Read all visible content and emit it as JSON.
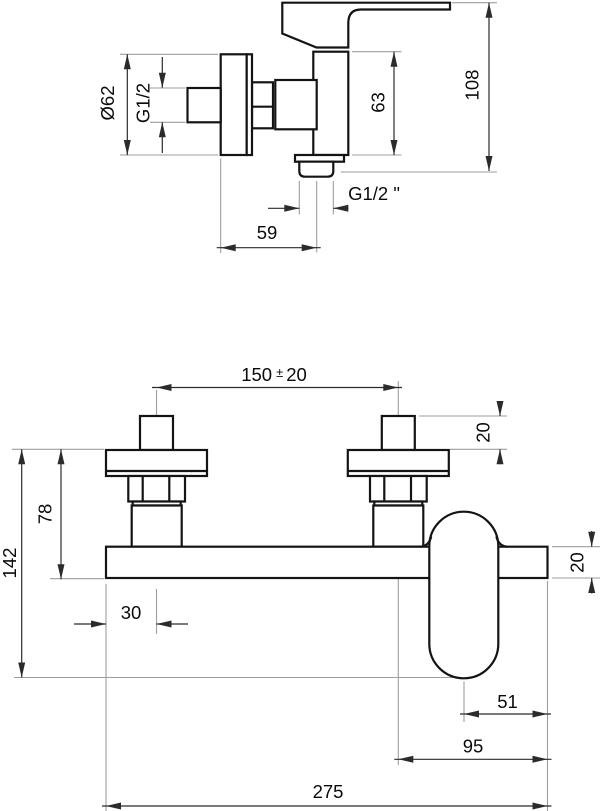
{
  "drawing": {
    "type": "technical-dimension-drawing",
    "subject": "wall-mounted single-lever shower mixer, two orthographic views with dimensions (mm)",
    "colors": {
      "background": "#ffffff",
      "object_line": "#141414",
      "dimension_line": "#2b2b2b",
      "extension_line": "#9e9e9e",
      "text": "#0a0a0a"
    },
    "side_view": {
      "dims": {
        "flange_diameter": "Ø62",
        "inlet_thread": "G1/2",
        "body_height": "63",
        "overall_height": "108",
        "wall_to_outlet": "59",
        "outlet_thread": "G1/2 \""
      }
    },
    "front_view": {
      "dims": {
        "inlet_spacing_value": "150",
        "inlet_spacing_tol_sign": "±",
        "inlet_spacing_tol": "20",
        "inlet_stub_height": "20",
        "leg_height": "78",
        "overall_height": "142",
        "edge_to_inlet_center": "30",
        "body_bar_height": "20",
        "outlet_center_to_edge": "51",
        "inlet_center_to_edge": "95",
        "overall_width": "275"
      }
    }
  }
}
